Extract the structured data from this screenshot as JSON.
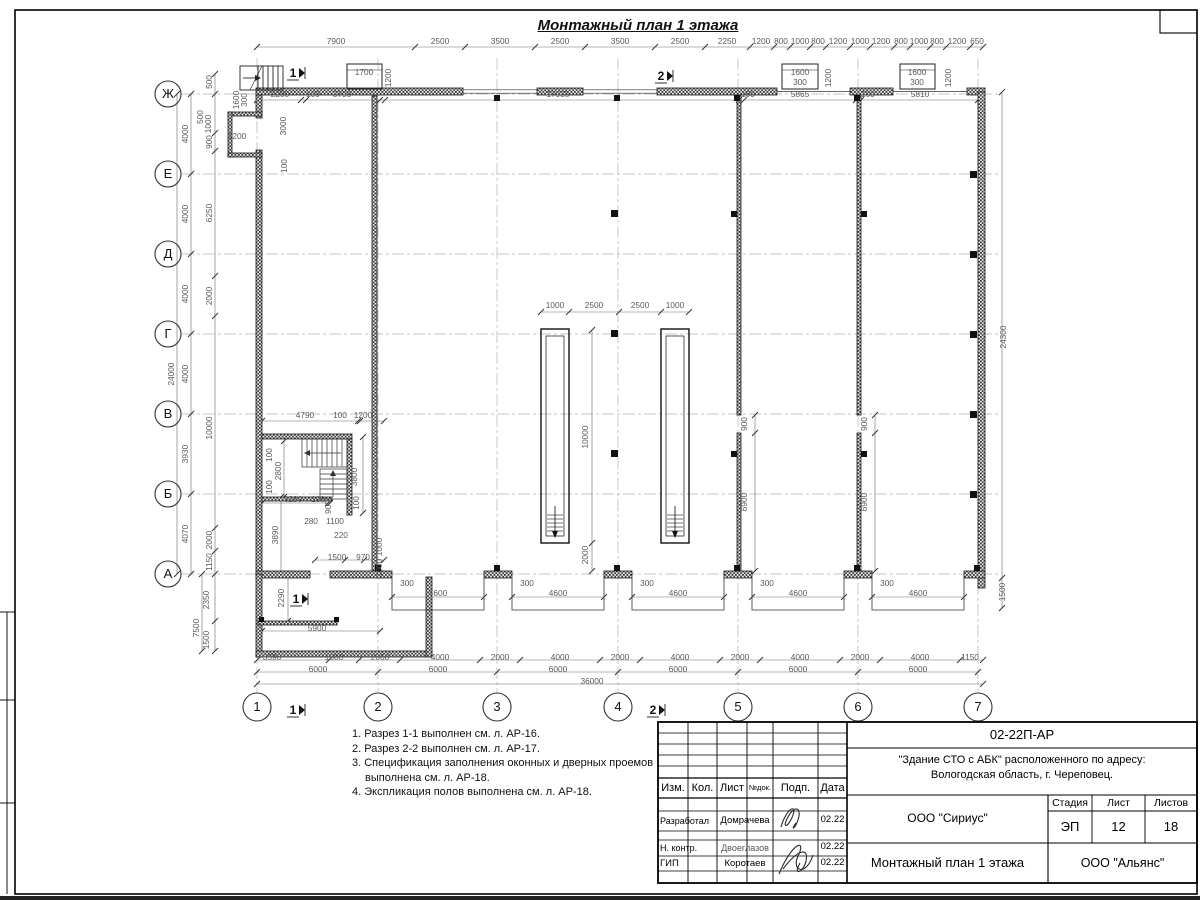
{
  "page_title": "Монтажный план 1 этажа",
  "axes": {
    "rows": [
      {
        "label": "Ж",
        "y": 94
      },
      {
        "label": "Е",
        "y": 174
      },
      {
        "label": "Д",
        "y": 254
      },
      {
        "label": "Г",
        "y": 334
      },
      {
        "label": "В",
        "y": 414
      },
      {
        "label": "Б",
        "y": 494
      },
      {
        "label": "А",
        "y": 574
      }
    ],
    "cols": [
      {
        "label": "1",
        "x": 257
      },
      {
        "label": "2",
        "x": 378
      },
      {
        "label": "3",
        "x": 497
      },
      {
        "label": "4",
        "x": 618
      },
      {
        "label": "5",
        "x": 738
      },
      {
        "label": "6",
        "x": 858
      },
      {
        "label": "7",
        "x": 978
      }
    ]
  },
  "dims": [
    {
      "t": "7900",
      "x": 336,
      "y": 44
    },
    {
      "t": "2500",
      "x": 440,
      "y": 44
    },
    {
      "t": "3500",
      "x": 500,
      "y": 44
    },
    {
      "t": "2500",
      "x": 560,
      "y": 44
    },
    {
      "t": "3500",
      "x": 620,
      "y": 44
    },
    {
      "t": "2500",
      "x": 680,
      "y": 44
    },
    {
      "t": "2250",
      "x": 727,
      "y": 44
    },
    {
      "t": "1200",
      "x": 761,
      "y": 44
    },
    {
      "t": "800",
      "x": 781,
      "y": 44
    },
    {
      "t": "1000",
      "x": 800,
      "y": 44
    },
    {
      "t": "800",
      "x": 818,
      "y": 44
    },
    {
      "t": "1200",
      "x": 838,
      "y": 44
    },
    {
      "t": "1000",
      "x": 860,
      "y": 44
    },
    {
      "t": "1200",
      "x": 881,
      "y": 44
    },
    {
      "t": "800",
      "x": 901,
      "y": 44
    },
    {
      "t": "1000",
      "x": 919,
      "y": 44
    },
    {
      "t": "800",
      "x": 937,
      "y": 44
    },
    {
      "t": "1200",
      "x": 957,
      "y": 44
    },
    {
      "t": "650",
      "x": 977,
      "y": 44
    },
    {
      "t": "1700",
      "x": 364,
      "y": 75
    },
    {
      "t": "1200",
      "x": 391,
      "y": 78,
      "r": 1
    },
    {
      "t": "1600",
      "x": 800,
      "y": 75
    },
    {
      "t": "300",
      "x": 800,
      "y": 85
    },
    {
      "t": "1200",
      "x": 831,
      "y": 78,
      "r": 1
    },
    {
      "t": "1600",
      "x": 917,
      "y": 75
    },
    {
      "t": "300",
      "x": 917,
      "y": 85
    },
    {
      "t": "1200",
      "x": 951,
      "y": 78,
      "r": 1
    },
    {
      "t": "2200",
      "x": 280,
      "y": 97
    },
    {
      "t": "100",
      "x": 313,
      "y": 97
    },
    {
      "t": "3790",
      "x": 342,
      "y": 97
    },
    {
      "t": "17935",
      "x": 558,
      "y": 97
    },
    {
      "t": "100",
      "x": 748,
      "y": 97
    },
    {
      "t": "5865",
      "x": 800,
      "y": 97
    },
    {
      "t": "100",
      "x": 868,
      "y": 97
    },
    {
      "t": "5810",
      "x": 920,
      "y": 97
    },
    {
      "t": "24000",
      "x": 174,
      "y": 374,
      "r": 1
    },
    {
      "t": "4000",
      "x": 188,
      "y": 134,
      "r": 1
    },
    {
      "t": "4000",
      "x": 188,
      "y": 214,
      "r": 1
    },
    {
      "t": "4000",
      "x": 188,
      "y": 294,
      "r": 1
    },
    {
      "t": "4000",
      "x": 188,
      "y": 374,
      "r": 1
    },
    {
      "t": "3930",
      "x": 188,
      "y": 454,
      "r": 1
    },
    {
      "t": "4070",
      "x": 188,
      "y": 534,
      "r": 1
    },
    {
      "t": "500",
      "x": 212,
      "y": 82,
      "r": 1
    },
    {
      "t": "500",
      "x": 203,
      "y": 117,
      "r": 1
    },
    {
      "t": "1000",
      "x": 211,
      "y": 124,
      "r": 1
    },
    {
      "t": "1600",
      "x": 239,
      "y": 100,
      "r": 1
    },
    {
      "t": "300",
      "x": 247,
      "y": 100,
      "r": 1
    },
    {
      "t": "1200",
      "x": 237,
      "y": 139
    },
    {
      "t": "3000",
      "x": 286,
      "y": 126,
      "r": 1
    },
    {
      "t": "100",
      "x": 287,
      "y": 166,
      "r": 1
    },
    {
      "t": "900",
      "x": 212,
      "y": 142,
      "r": 1
    },
    {
      "t": "6250",
      "x": 212,
      "y": 213,
      "r": 1
    },
    {
      "t": "2000",
      "x": 212,
      "y": 296,
      "r": 1
    },
    {
      "t": "10000",
      "x": 212,
      "y": 428,
      "r": 1
    },
    {
      "t": "2000",
      "x": 212,
      "y": 540,
      "r": 1
    },
    {
      "t": "1150",
      "x": 212,
      "y": 562,
      "r": 1
    },
    {
      "t": "2350",
      "x": 209,
      "y": 600,
      "r": 1
    },
    {
      "t": "1500",
      "x": 209,
      "y": 640,
      "r": 1
    },
    {
      "t": "7500",
      "x": 199,
      "y": 628,
      "r": 1
    },
    {
      "t": "24300",
      "x": 1006,
      "y": 337,
      "r": 1
    },
    {
      "t": "1500",
      "x": 1005,
      "y": 592,
      "r": 1
    },
    {
      "t": "4790",
      "x": 305,
      "y": 418
    },
    {
      "t": "100",
      "x": 340,
      "y": 418
    },
    {
      "t": "1200",
      "x": 363,
      "y": 418
    },
    {
      "t": "100",
      "x": 272,
      "y": 455,
      "r": 1
    },
    {
      "t": "2800",
      "x": 281,
      "y": 471,
      "r": 1
    },
    {
      "t": "100",
      "x": 272,
      "y": 487,
      "r": 1
    },
    {
      "t": "3800",
      "x": 357,
      "y": 477,
      "r": 1
    },
    {
      "t": "100",
      "x": 359,
      "y": 503,
      "r": 1
    },
    {
      "t": "3290",
      "x": 293,
      "y": 502
    },
    {
      "t": "100",
      "x": 318,
      "y": 502
    },
    {
      "t": "900",
      "x": 331,
      "y": 507,
      "r": 1
    },
    {
      "t": "280",
      "x": 311,
      "y": 524
    },
    {
      "t": "1100",
      "x": 335,
      "y": 524
    },
    {
      "t": "220",
      "x": 341,
      "y": 538
    },
    {
      "t": "3890",
      "x": 278,
      "y": 535,
      "r": 1
    },
    {
      "t": "1500",
      "x": 337,
      "y": 560
    },
    {
      "t": "970",
      "x": 363,
      "y": 560
    },
    {
      "t": "1000",
      "x": 382,
      "y": 547,
      "r": 1
    },
    {
      "t": "1000",
      "x": 382,
      "y": 568,
      "r": 1
    },
    {
      "t": "2290",
      "x": 284,
      "y": 598,
      "r": 1
    },
    {
      "t": "5900",
      "x": 317,
      "y": 631
    },
    {
      "t": "1000",
      "x": 555,
      "y": 308
    },
    {
      "t": "2500",
      "x": 594,
      "y": 308
    },
    {
      "t": "2500",
      "x": 640,
      "y": 308
    },
    {
      "t": "1000",
      "x": 675,
      "y": 308
    },
    {
      "t": "10000",
      "x": 588,
      "y": 437,
      "r": 1
    },
    {
      "t": "2000",
      "x": 588,
      "y": 555,
      "r": 1
    },
    {
      "t": "900",
      "x": 747,
      "y": 424,
      "r": 1
    },
    {
      "t": "6900",
      "x": 747,
      "y": 502,
      "r": 1
    },
    {
      "t": "900",
      "x": 867,
      "y": 424,
      "r": 1
    },
    {
      "t": "6900",
      "x": 867,
      "y": 502,
      "r": 1
    },
    {
      "t": "300",
      "x": 407,
      "y": 586
    },
    {
      "t": "4600",
      "x": 438,
      "y": 596
    },
    {
      "t": "300",
      "x": 527,
      "y": 586
    },
    {
      "t": "4600",
      "x": 558,
      "y": 596
    },
    {
      "t": "300",
      "x": 647,
      "y": 586
    },
    {
      "t": "4600",
      "x": 678,
      "y": 596
    },
    {
      "t": "300",
      "x": 767,
      "y": 586
    },
    {
      "t": "4600",
      "x": 798,
      "y": 596
    },
    {
      "t": "300",
      "x": 887,
      "y": 586
    },
    {
      "t": "4600",
      "x": 918,
      "y": 596
    },
    {
      "t": "3590",
      "x": 272,
      "y": 660
    },
    {
      "t": "1500",
      "x": 334,
      "y": 660
    },
    {
      "t": "2060",
      "x": 380,
      "y": 660
    },
    {
      "t": "4000",
      "x": 440,
      "y": 660
    },
    {
      "t": "2000",
      "x": 500,
      "y": 660
    },
    {
      "t": "4000",
      "x": 560,
      "y": 660
    },
    {
      "t": "2000",
      "x": 620,
      "y": 660
    },
    {
      "t": "4000",
      "x": 680,
      "y": 660
    },
    {
      "t": "2000",
      "x": 740,
      "y": 660
    },
    {
      "t": "4000",
      "x": 800,
      "y": 660
    },
    {
      "t": "2000",
      "x": 860,
      "y": 660
    },
    {
      "t": "4000",
      "x": 920,
      "y": 660
    },
    {
      "t": "1150",
      "x": 970,
      "y": 660
    },
    {
      "t": "6000",
      "x": 318,
      "y": 672
    },
    {
      "t": "6000",
      "x": 438,
      "y": 672
    },
    {
      "t": "6000",
      "x": 558,
      "y": 672
    },
    {
      "t": "6000",
      "x": 678,
      "y": 672
    },
    {
      "t": "6000",
      "x": 798,
      "y": 672
    },
    {
      "t": "6000",
      "x": 918,
      "y": 672
    },
    {
      "t": "36000",
      "x": 592,
      "y": 684
    }
  ],
  "sections": [
    {
      "t": "1",
      "x": 293,
      "y": 77
    },
    {
      "t": "2",
      "x": 661,
      "y": 80
    },
    {
      "t": "1",
      "x": 296,
      "y": 603
    },
    {
      "t": "1",
      "x": 293,
      "y": 714
    },
    {
      "t": "2",
      "x": 653,
      "y": 714
    }
  ],
  "notes": [
    "1. Разрез 1-1 выполнен см. л. АР-16.",
    "2. Разрез 2-2 выполнен см. л. АР-17.",
    "3. Спецификация заполнения оконных и дверных проемов выполнена см. л. АР-18.",
    "4. Экспликация полов выполнена см. л. АР-18."
  ],
  "titleblock": {
    "doc_number": "02-22П-АР",
    "project_line1": "\"Здание СТО с АБК\" расположенного по адресу:",
    "project_line2": "Вологодская область, г. Череповец.",
    "header": {
      "izm": "Изм.",
      "kol": "Кол.",
      "list": "Лист",
      "ndok": "№док.",
      "podp": "Подп.",
      "data": "Дата"
    },
    "rows": [
      {
        "role": "Разработал",
        "name": "Домрачева",
        "date": "02.22"
      },
      {
        "role": "Н. контр.",
        "name": "Двоеглазов",
        "date": "02.22"
      },
      {
        "role": "ГИП",
        "name": "Коротаев",
        "date": "02.22"
      }
    ],
    "org1": "ООО \"Сириус\"",
    "stage_label": "Стадия",
    "sheet_label": "Лист",
    "sheets_label": "Листов",
    "stage": "ЭП",
    "sheet_no": "12",
    "sheets_total": "18",
    "drawing_name": "Монтажный план 1 этажа",
    "org2": "ООО \"Альянс\""
  }
}
